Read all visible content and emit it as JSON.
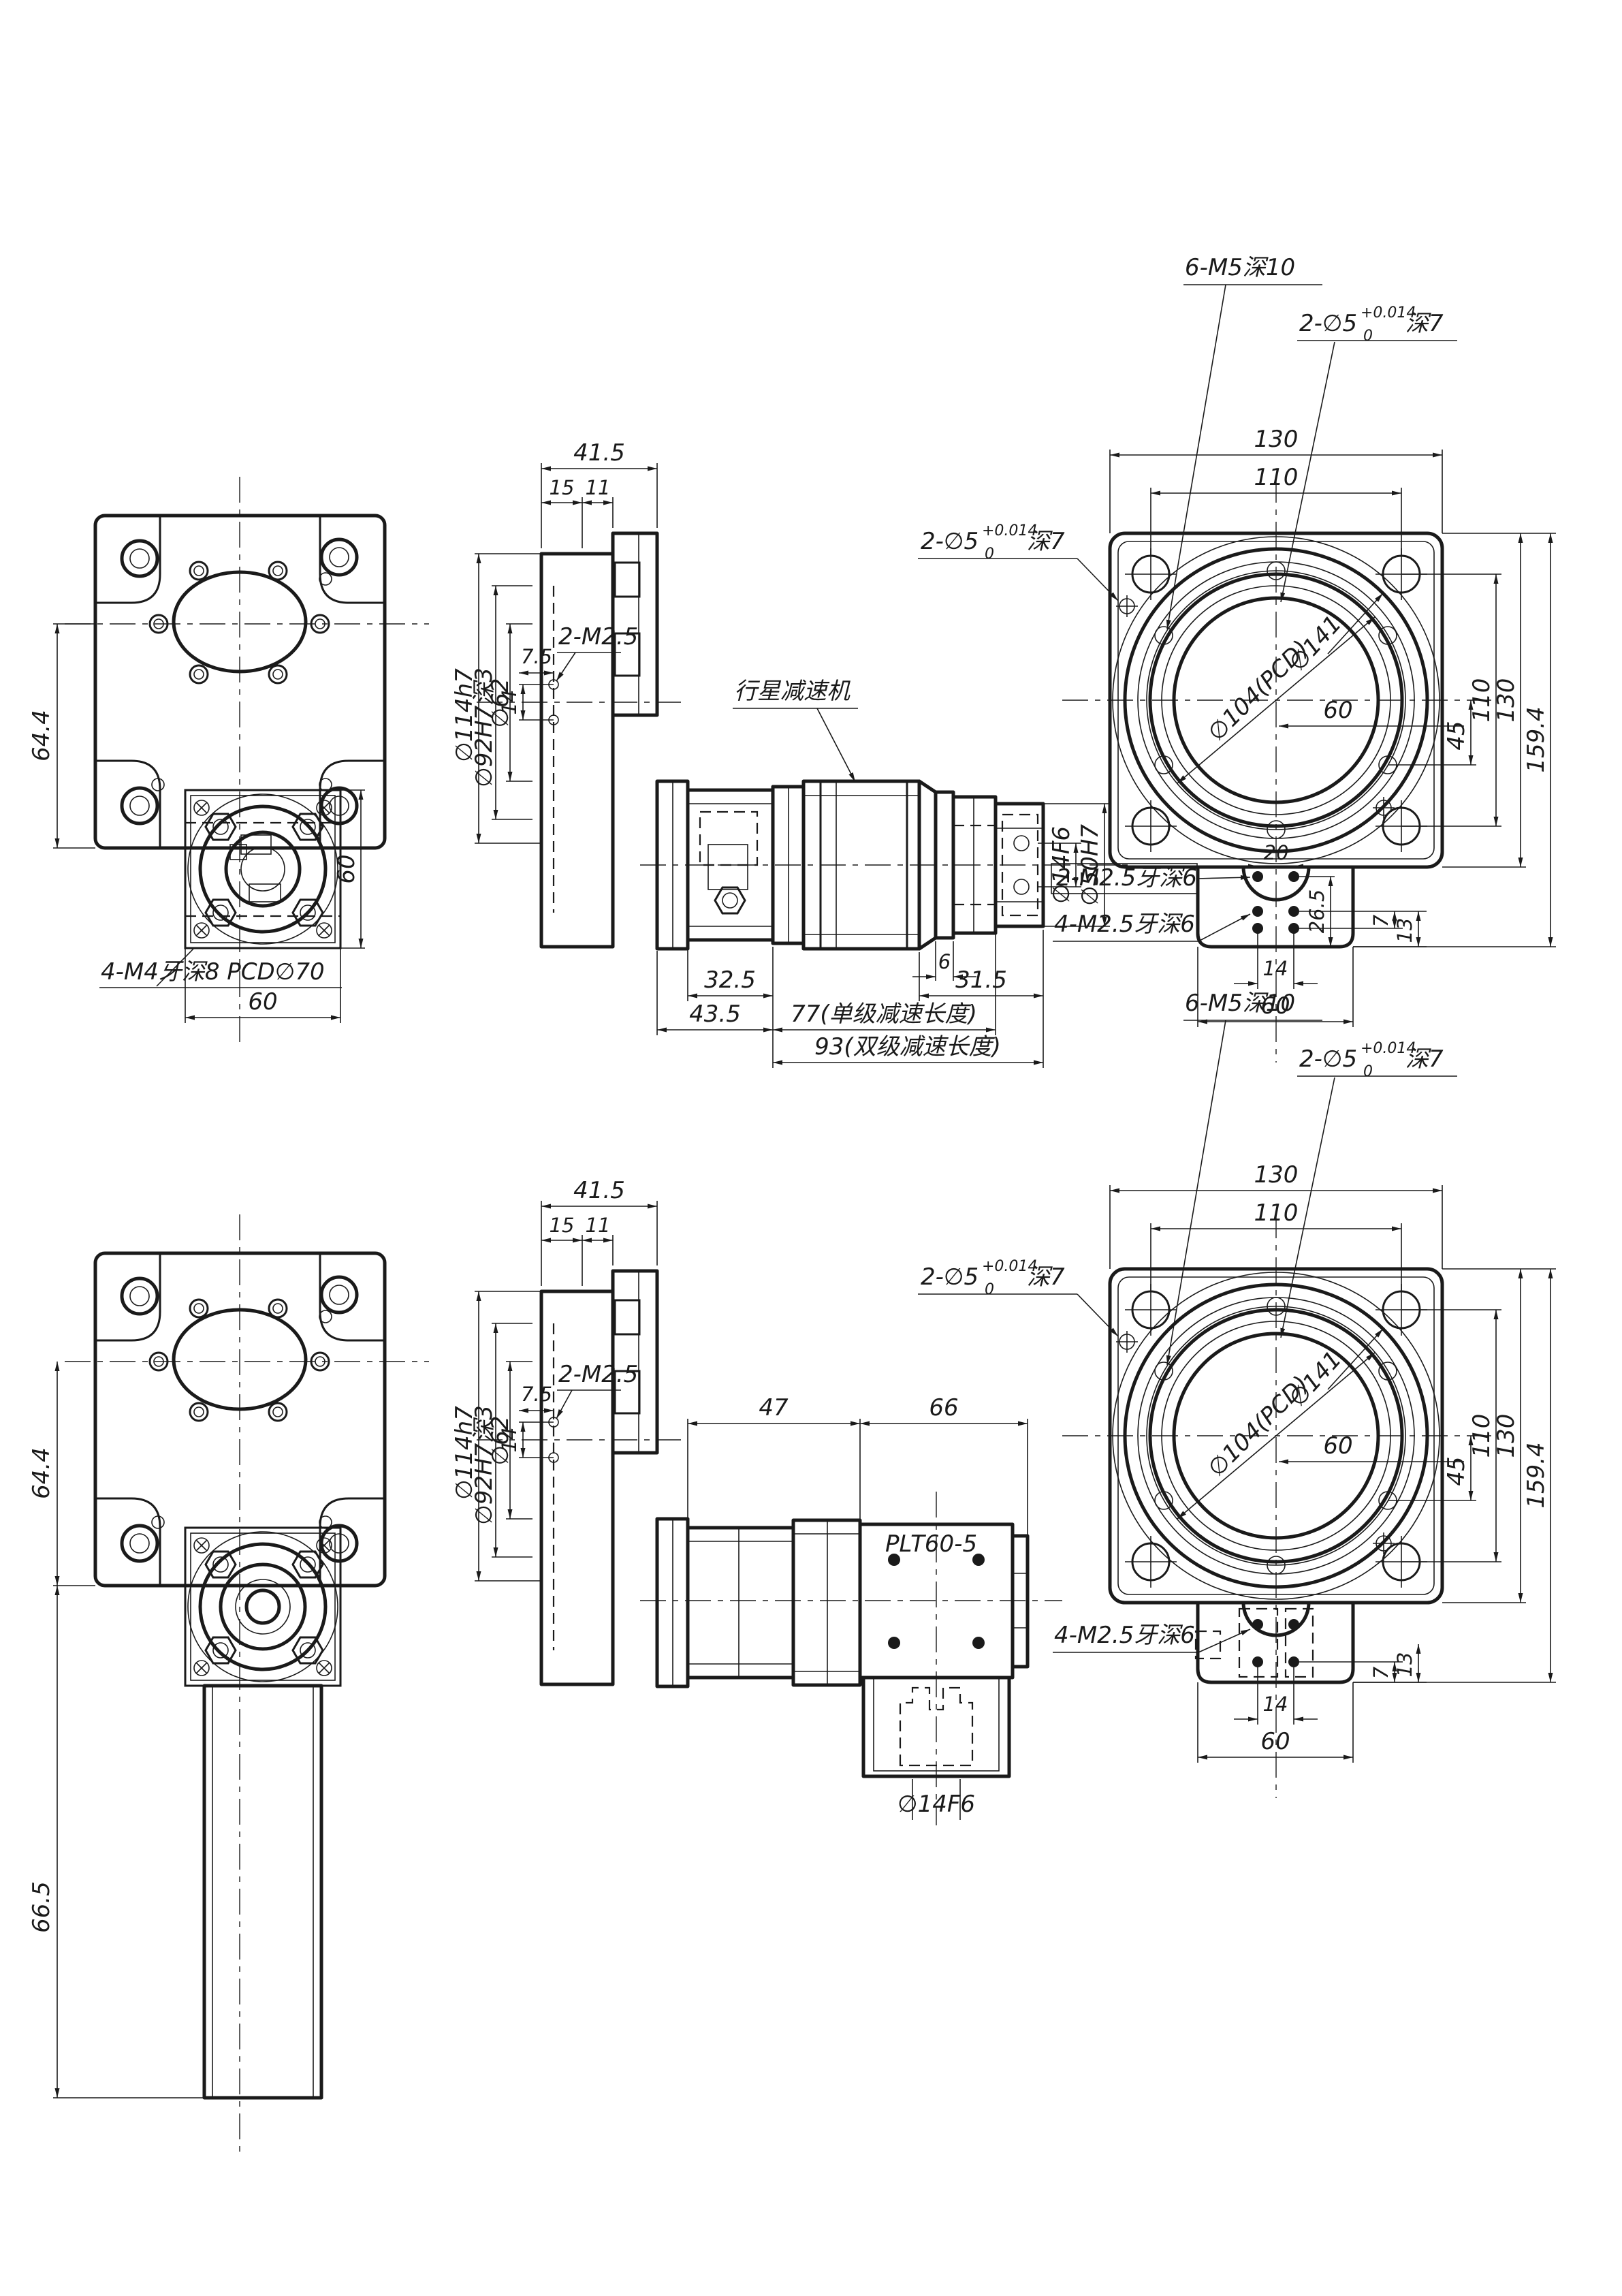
{
  "drawing_type": "engineering-cad-drawing",
  "colors": {
    "background": "#ffffff",
    "ink": "#1a1a1a"
  },
  "notes": {
    "m4": "4-M4牙深8 PCD∅70",
    "m5": "6-M5深10",
    "pin_prefix": "2-∅5",
    "pin_sup": "+0.014",
    "pin_sub": "0",
    "pin_suffix": "深7",
    "m25": "2-M2.5",
    "m25x2": "2-M2.5牙深6",
    "m25x4": "4-M2.5牙深6",
    "planetary": "行星减速机",
    "model": "PLT60-5"
  },
  "dims": {
    "d6": "6",
    "d7": "7",
    "d11": "11",
    "d13": "13",
    "d14": "14",
    "d15": "15",
    "d20": "20",
    "d26_5": "26.5",
    "d31_5": "31.5",
    "d32_5": "32.5",
    "d41_5": "41.5",
    "d43_5": "43.5",
    "d45": "45",
    "d47": "47",
    "d60": "60",
    "d64_4": "64.4",
    "d66": "66",
    "d66_5": "66.5",
    "d75": "7.5",
    "d77": "77(单级减速长度)",
    "d93": "93(双级减速长度)",
    "d110": "110",
    "d130": "130",
    "d159_4": "159.4",
    "dia14": "∅14F6",
    "dia50": "∅50H7",
    "dia62": "∅62",
    "dia92": "∅92H7深3",
    "dia104": "∅104(PCD)",
    "dia114": "∅114h7",
    "dia141": "∅141"
  }
}
